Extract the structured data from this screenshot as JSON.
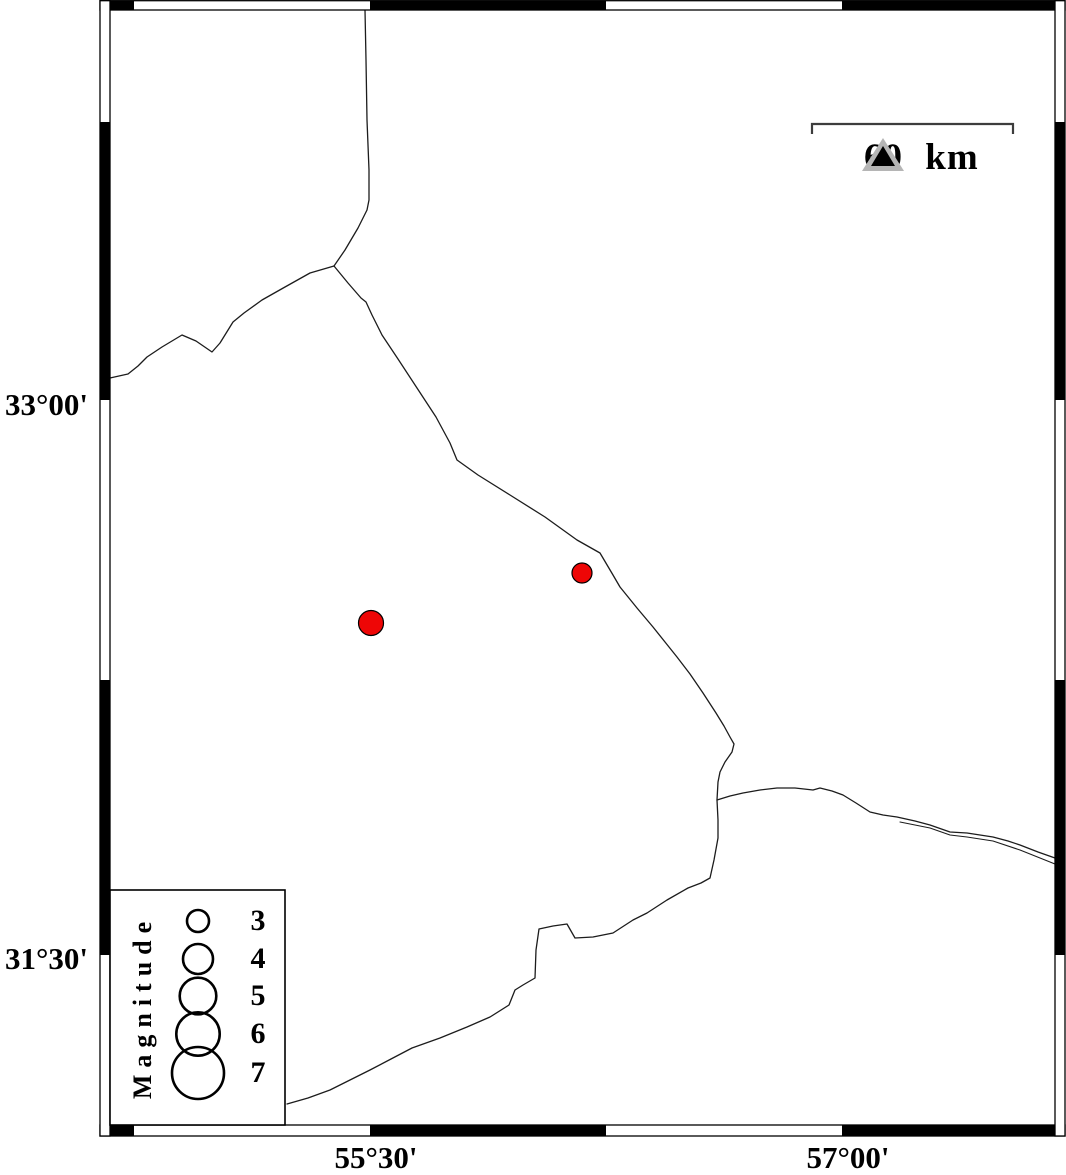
{
  "map": {
    "background_color": "#ffffff",
    "frame_color": "#000000",
    "line_color": "#1c1c1c",
    "epicenter_color": "#ee0606",
    "lat_labels": [
      {
        "text": "33°00'",
        "y": 400
      },
      {
        "text": "31°30'",
        "y": 955
      }
    ],
    "lon_labels": [
      {
        "text": "55°30'",
        "x": 370
      },
      {
        "text": "57°00'",
        "x": 842
      }
    ],
    "frame": {
      "white_bands": [
        {
          "x": 100,
          "y": 0.7,
          "w": 965,
          "h": 9.3
        },
        {
          "x": 100,
          "y": 1125,
          "w": 965,
          "h": 11
        },
        {
          "x": 100,
          "y": 0.7,
          "w": 10,
          "h": 1135.3
        },
        {
          "x": 1055,
          "y": 0.7,
          "w": 10,
          "h": 1135.3
        }
      ],
      "black_segments": [
        {
          "x": 110,
          "y": 0.7,
          "w": 24,
          "h": 9.3
        },
        {
          "x": 370,
          "y": 0.7,
          "w": 236,
          "h": 9.3
        },
        {
          "x": 842,
          "y": 0.7,
          "w": 213,
          "h": 9.3
        },
        {
          "x": 110,
          "y": 1125,
          "w": 24,
          "h": 11
        },
        {
          "x": 370,
          "y": 1125,
          "w": 236,
          "h": 11
        },
        {
          "x": 842,
          "y": 1125,
          "w": 213,
          "h": 11
        },
        {
          "x": 100,
          "y": 122,
          "w": 10,
          "h": 278
        },
        {
          "x": 100,
          "y": 680,
          "w": 10,
          "h": 275
        },
        {
          "x": 1055,
          "y": 122,
          "w": 10,
          "h": 278
        },
        {
          "x": 1055,
          "y": 680,
          "w": 10,
          "h": 275
        }
      ]
    },
    "border_lines": [
      {
        "name": "north-border",
        "width": 1.3,
        "points": [
          [
            365,
            10
          ],
          [
            366,
            60
          ],
          [
            367,
            120
          ],
          [
            369,
            170
          ],
          [
            369,
            200
          ],
          [
            367,
            210
          ],
          [
            358,
            228
          ],
          [
            345,
            250
          ],
          [
            334,
            266
          ]
        ]
      },
      {
        "name": "northwest-border",
        "width": 1.3,
        "points": [
          [
            334,
            266
          ],
          [
            310,
            273
          ],
          [
            285,
            287
          ],
          [
            262,
            300
          ],
          [
            244,
            313
          ],
          [
            233,
            322
          ],
          [
            220,
            343
          ],
          [
            212,
            352
          ],
          [
            196,
            341
          ],
          [
            182,
            335
          ],
          [
            162,
            347
          ],
          [
            147,
            357
          ],
          [
            138,
            366
          ],
          [
            128,
            374
          ],
          [
            110,
            378
          ]
        ]
      },
      {
        "name": "main-diagonal-border",
        "width": 1.3,
        "points": [
          [
            334,
            266
          ],
          [
            348,
            283
          ],
          [
            361,
            298
          ],
          [
            366,
            302
          ],
          [
            372,
            315
          ],
          [
            382,
            335
          ],
          [
            398,
            359
          ],
          [
            417,
            388
          ],
          [
            436,
            417
          ],
          [
            450,
            443
          ],
          [
            457,
            460
          ],
          [
            478,
            475
          ],
          [
            510,
            495
          ],
          [
            545,
            517
          ],
          [
            577,
            540
          ],
          [
            600,
            553
          ],
          [
            613,
            575
          ],
          [
            620,
            587
          ],
          [
            637,
            608
          ],
          [
            653,
            627
          ],
          [
            665,
            642
          ],
          [
            677,
            657
          ],
          [
            690,
            674
          ],
          [
            703,
            693
          ],
          [
            716,
            713
          ],
          [
            724,
            726
          ],
          [
            730,
            737
          ],
          [
            734,
            744
          ],
          [
            732,
            752
          ],
          [
            725,
            762
          ],
          [
            720,
            772
          ],
          [
            718,
            782
          ],
          [
            717,
            800
          ],
          [
            718,
            820
          ],
          [
            718,
            838
          ],
          [
            714,
            860
          ],
          [
            710,
            878
          ],
          [
            701,
            883
          ],
          [
            688,
            888
          ],
          [
            667,
            900
          ],
          [
            647,
            913
          ],
          [
            633,
            920
          ],
          [
            613,
            933
          ],
          [
            593,
            937
          ],
          [
            575,
            938
          ],
          [
            567,
            924
          ],
          [
            553,
            926
          ],
          [
            539,
            929
          ],
          [
            536,
            950
          ],
          [
            535,
            978
          ],
          [
            523,
            985
          ],
          [
            515,
            990
          ],
          [
            509,
            1005
          ],
          [
            490,
            1017
          ],
          [
            467,
            1027
          ],
          [
            440,
            1038
          ],
          [
            412,
            1048
          ],
          [
            391,
            1059
          ],
          [
            370,
            1070
          ],
          [
            350,
            1080
          ],
          [
            330,
            1090
          ],
          [
            308,
            1098
          ],
          [
            287,
            1104
          ]
        ]
      },
      {
        "name": "east-border",
        "width": 1.3,
        "points": [
          [
            717,
            800
          ],
          [
            730,
            796
          ],
          [
            743,
            793
          ],
          [
            760,
            790
          ],
          [
            777,
            788
          ],
          [
            795,
            788
          ],
          [
            813,
            790
          ],
          [
            820,
            788
          ],
          [
            832,
            791
          ],
          [
            843,
            795
          ],
          [
            856,
            803
          ],
          [
            870,
            812
          ],
          [
            883,
            815
          ],
          [
            897,
            817
          ],
          [
            915,
            821
          ],
          [
            930,
            825
          ],
          [
            950,
            832
          ],
          [
            967,
            833
          ],
          [
            993,
            837
          ],
          [
            1008,
            841
          ],
          [
            1020,
            845
          ],
          [
            1038,
            852
          ],
          [
            1055,
            858
          ]
        ]
      },
      {
        "name": "east-border-companion",
        "width": 1.1,
        "points": [
          [
            900,
            822
          ],
          [
            930,
            828
          ],
          [
            950,
            835
          ],
          [
            967,
            837
          ],
          [
            993,
            841
          ],
          [
            1020,
            850
          ],
          [
            1040,
            858
          ],
          [
            1055,
            864
          ]
        ]
      }
    ],
    "epicenters": [
      {
        "x": 371,
        "y": 623,
        "r": 12.5,
        "magnitude_approx": 3.4
      },
      {
        "x": 582,
        "y": 573,
        "r": 10,
        "magnitude_approx": 3.0
      }
    ]
  },
  "scale_bar": {
    "label": "60 km",
    "x1": 812,
    "x2": 1013,
    "y": 124,
    "tick_drop": 10,
    "color": "#3d3d3d"
  },
  "station_marker": {
    "fill": "#b5b5b5",
    "inner_fill": "#000000"
  },
  "legend": {
    "title": "Magnitude",
    "box": {
      "x": 110,
      "y": 890,
      "w": 175,
      "h": 235
    },
    "circle_cx": 198,
    "circle_stroke": "#000000",
    "entries": [
      {
        "label": "3",
        "r": 11,
        "cy": 921
      },
      {
        "label": "4",
        "r": 15,
        "cy": 959
      },
      {
        "label": "5",
        "r": 18.3,
        "cy": 996
      },
      {
        "label": "6",
        "r": 21.7,
        "cy": 1034
      },
      {
        "label": "7",
        "r": 26,
        "cy": 1073
      }
    ]
  }
}
